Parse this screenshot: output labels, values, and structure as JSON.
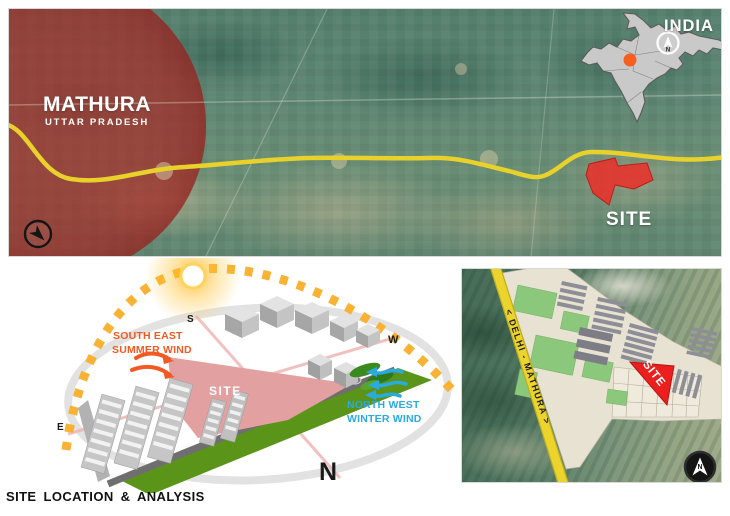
{
  "footer": {
    "title": "SITE LOCATION & ANALYSIS"
  },
  "top_map": {
    "city": "MATHURA",
    "state": "UTTAR PRADESH",
    "site": "SITE",
    "inset": {
      "country": "INDIA",
      "compass_letter": "N"
    }
  },
  "diagram": {
    "site": "SITE",
    "dir_south": "S",
    "dir_west": "W",
    "dir_east": "E",
    "dir_north": "N",
    "summer_wind_line1": "SOUTH EAST",
    "summer_wind_line2": "SUMMER WIND",
    "winter_wind_line1": "NORTH WEST",
    "winter_wind_line2": "WINTER WIND"
  },
  "inset_map": {
    "road": "< DELHI - MATHURA >",
    "site": "SITE",
    "compass_letter": "N"
  },
  "colors": {
    "mathura_overlay": "#a82c28",
    "highway_yellow": "#e9d12c",
    "site_red": "#e8312a",
    "site_pink": "#e2a1a0",
    "summer_wind_orange": "#f15a24",
    "winter_wind_blue": "#29abe2",
    "sun_path_yellow": "#f9b233",
    "green_buffer": "#5a9519",
    "india_gray": "#c9c9c9"
  }
}
